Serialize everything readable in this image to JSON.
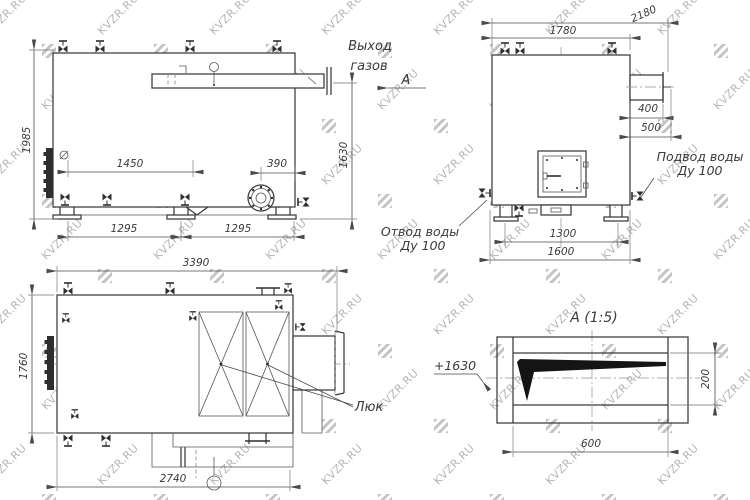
{
  "watermark": {
    "text": "KVZR.RU",
    "text_color": "#b6b6b6",
    "logo_color": "#c3c3c3"
  },
  "front_view": {
    "gas_outlet_label_line1": "Выход",
    "gas_outlet_label_line2": "газов",
    "section_arrow_label": "А",
    "dim_height_overall": "1985",
    "dim_top_span": "1450",
    "dim_flange_offset": "390",
    "dim_gas_outlet_height": "1630",
    "dim_base_left": "1295",
    "dim_base_right": "1295"
  },
  "rear_view": {
    "dim_width_overall": "2180",
    "dim_body_width": "1780",
    "dim_duct_length": "400",
    "dim_duct_total": "500",
    "dim_base_inner": "1300",
    "dim_base_outer": "1600",
    "water_supply_label_line1": "Подвод воды",
    "water_supply_label_line2": "Ду 100",
    "water_return_label_line1": "Отвод воды",
    "water_return_label_line2": "Ду 100"
  },
  "plan_view": {
    "dim_length_overall": "3390",
    "dim_width": "1760",
    "dim_base_length": "2740",
    "hatch_label": "Люк"
  },
  "detail_view": {
    "title": "А (1:5)",
    "elevation_label": "+1630",
    "dim_height": "200",
    "dim_width": "600"
  }
}
